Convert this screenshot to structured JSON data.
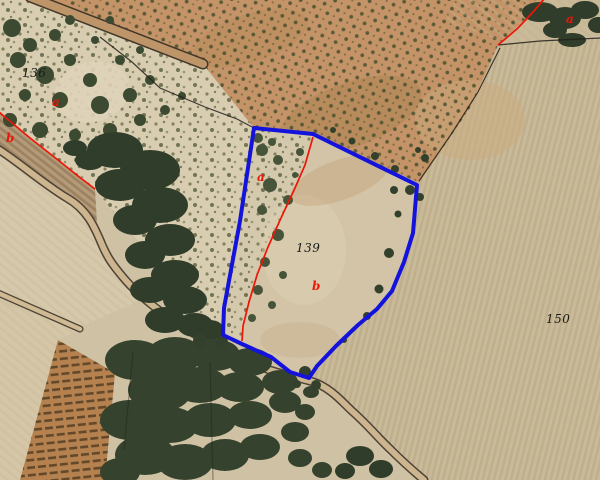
{
  "map": {
    "kind": "cadastral-aerial-orthophoto",
    "selected_parcel": "139",
    "colors": {
      "selected_parcel_outline": "#1313dc",
      "subparcel_boundary_red": "#ed1606",
      "other_boundary_black": "#23201a",
      "parcel_number_text": "#1a1a1a"
    },
    "parcel_labels": [
      {
        "text": "136",
        "x": 22,
        "y": 66
      },
      {
        "text": "139",
        "x": 296,
        "y": 241
      },
      {
        "text": "150",
        "x": 546,
        "y": 312
      }
    ],
    "subparcel_labels": [
      {
        "text": "a",
        "x": 52,
        "y": 95
      },
      {
        "text": "b",
        "x": 6,
        "y": 131
      },
      {
        "text": "a",
        "x": 257,
        "y": 170
      },
      {
        "text": "b",
        "x": 312,
        "y": 279
      },
      {
        "text": "a",
        "x": 566,
        "y": 12
      }
    ]
  }
}
